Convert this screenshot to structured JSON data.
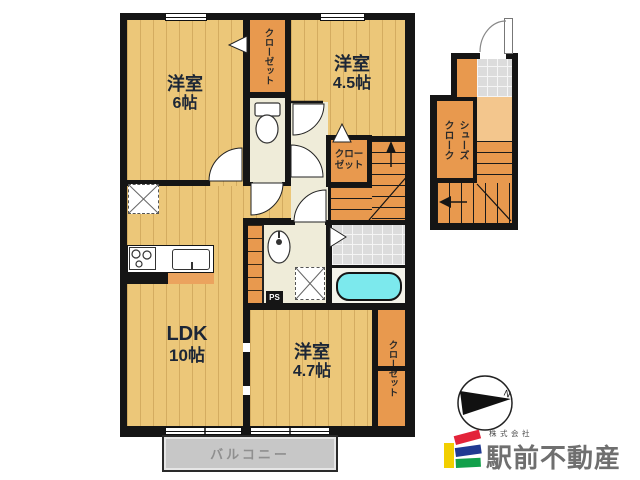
{
  "floorplan": {
    "rooms": {
      "bedroom_top_left": {
        "label": "洋室",
        "size": "6帖"
      },
      "bedroom_top_right": {
        "label": "洋室",
        "size": "4.5帖"
      },
      "ldk": {
        "label": "LDK",
        "size": "10帖"
      },
      "bedroom_bottom": {
        "label": "洋室",
        "size": "4.7帖"
      }
    },
    "storage": {
      "closet_top": "クローゼット",
      "closet_stairs_line1": "クロー",
      "closet_stairs_line2": "ゼット",
      "closet_bottom": "クローゼット",
      "shoe_cloak_col1": "シューズ",
      "shoe_cloak_col2": "クローク"
    },
    "other_labels": {
      "balcony": "バルコニー",
      "pipe_space": "PS",
      "compass_north": "N"
    }
  },
  "branding": {
    "company_prefix": "株式会社",
    "company_name": "駅前不動産"
  },
  "palette": {
    "wall": "#151515",
    "wood_floor": "#ecc779",
    "closet_orange": "#e8994e",
    "step_orange": "#f3c68d",
    "cream": "#efecd9",
    "tile_gray": "#dcdcdc",
    "bathtub_cyan": "#7ce9ed",
    "balcony_gray": "#c7c7c7",
    "logo_yellow": "#f2cf00",
    "logo_red": "#e32339",
    "logo_blue": "#203a92",
    "logo_green": "#12a04b",
    "logo_text_gray": "#6f6f6f"
  }
}
